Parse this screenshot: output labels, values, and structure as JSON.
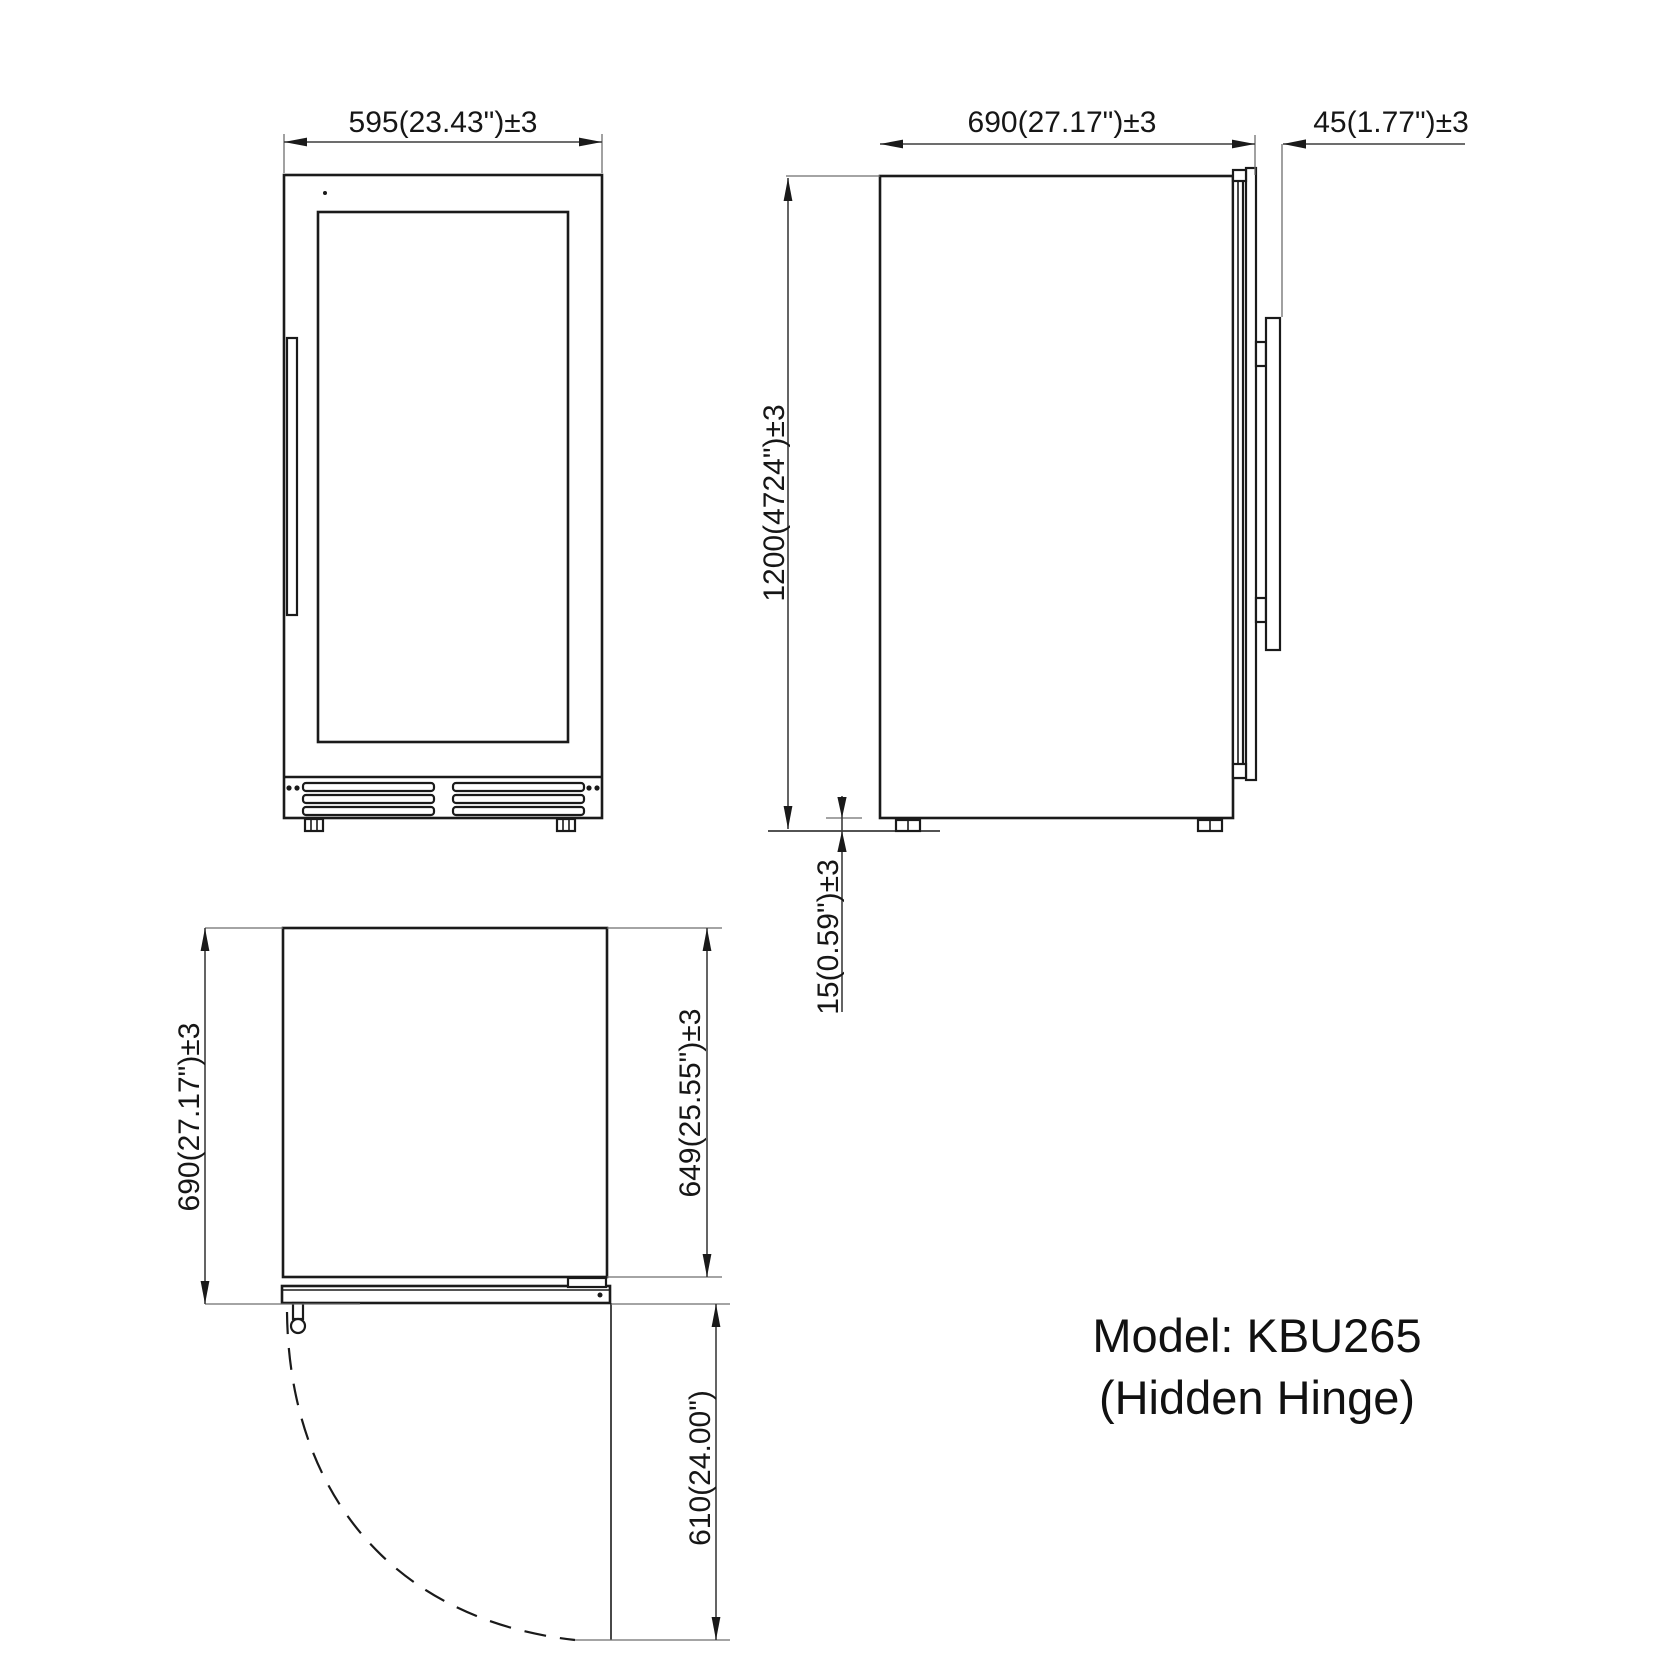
{
  "drawing": {
    "front_view": {
      "width_dim": "595(23.43\")±3"
    },
    "side_view": {
      "depth_dim": "690(27.17\")±3",
      "handle_depth_dim": "45(1.77\")±3",
      "height_dim": "1200(4724\")±3",
      "foot_clearance_dim": "15(0.59\")±3"
    },
    "top_view": {
      "overall_depth_dim": "690(27.17\")±3",
      "cabinet_depth_dim": "649(25.55\")±3",
      "door_swing_dim": "610(24.00\")"
    },
    "model": {
      "name_line": "Model: KBU265",
      "hinge_line": "(Hidden Hinge)"
    },
    "colors": {
      "line": "#1a1a1a",
      "dimension_line": "#3d3d3d",
      "extension_line": "#6e6e6e",
      "background": "#ffffff"
    }
  }
}
